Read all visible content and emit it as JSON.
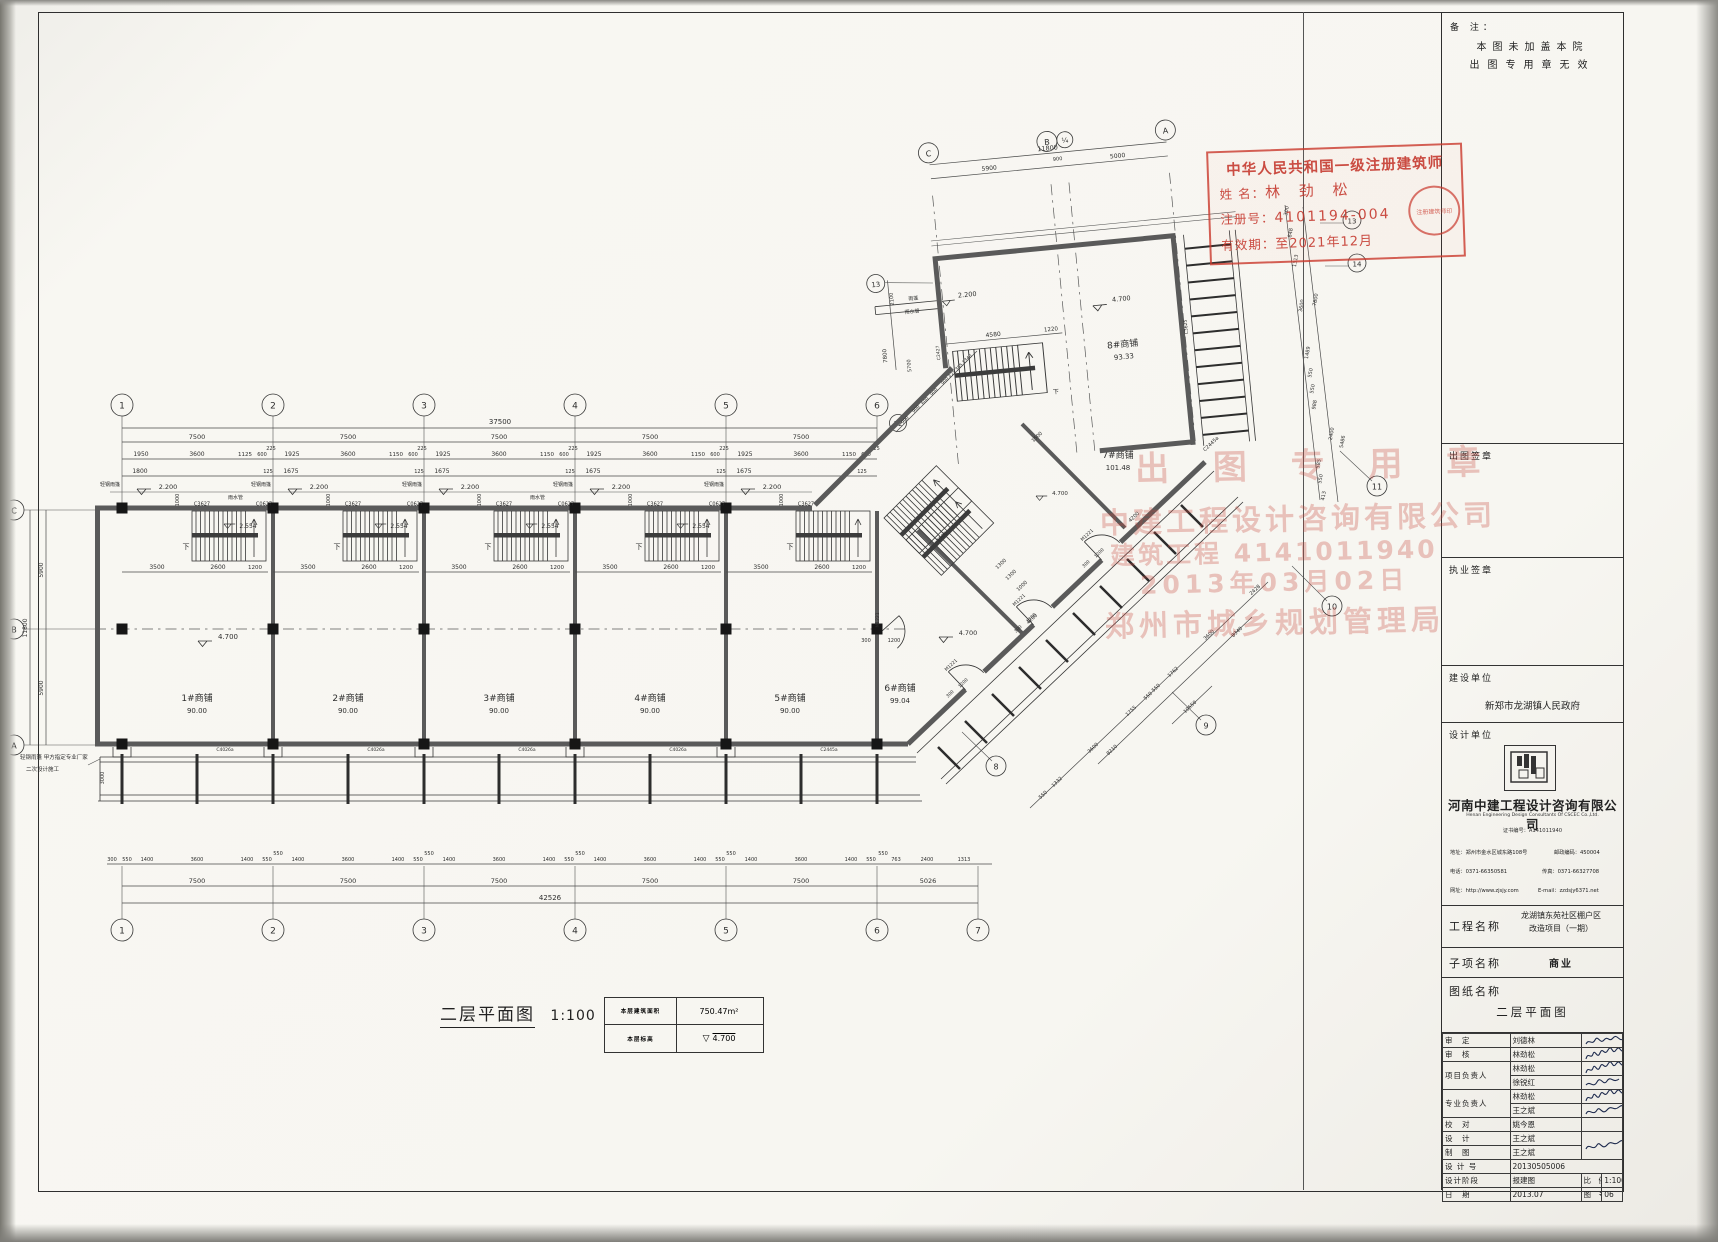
{
  "sheet": {
    "remark_label": "备 注：",
    "remark1": "本图未加盖本院",
    "remark2": "出图专用章无效"
  },
  "architect_stamp": {
    "title": "中华人民共和国一级注册建筑师",
    "name_label": "姓 名：",
    "name": "林 劲 松",
    "reg_label": "注册号：",
    "reg": "4101194-004",
    "valid_label": "有效期：",
    "valid": "至2021年12月",
    "seal": "注册建筑师印"
  },
  "faint_stamps": {
    "l1": "出 图 专 用 章",
    "l2": "中建工程设计咨询有限公司",
    "l3": "建筑工程 4141011940",
    "l4": "2013年03月02日",
    "l5": "郑州市城乡规划管理局"
  },
  "title_block": {
    "sign_out": "出图签章",
    "practice": "执业签章",
    "client_label": "建设单位",
    "client": "新郑市龙湖镇人民政府",
    "designer_label": "设计单位",
    "company": "河南中建工程设计咨询有限公司",
    "company_en": "Henan Engineering Design Consultants Of CSCEC Co.,Ltd.",
    "cert": "证书编号：A141011940",
    "addr": "地址：郑州市金水区城东路108号",
    "post": "邮政编码：450004",
    "tel": "电话：0371-66350581",
    "fax": "传真：0371-66327708",
    "web": "网址：http://www.zjsjy.com",
    "email": "E-mail：zzdsjy6371.net",
    "project_label": "工程名称",
    "project1": "龙湖镇东苑社区棚户区",
    "project2": "改造项目（一期）",
    "sub_label": "子项名称",
    "sub": "商业",
    "drawing_label": "图纸名称",
    "drawing": "二层平面图",
    "rows": [
      {
        "l": "审　定",
        "n": "刘德林"
      },
      {
        "l": "审　核",
        "n": "林劲松"
      },
      {
        "l": "项目负责人",
        "n": "林劲松"
      },
      {
        "l": "",
        "n": "徐锐红"
      },
      {
        "l": "专业负责人",
        "n": "林劲松"
      },
      {
        "l": "",
        "n": "王之斌"
      },
      {
        "l": "校　对",
        "n": "姚今恩"
      },
      {
        "l": "设　计",
        "n": "王之斌"
      },
      {
        "l": "制　图",
        "n": "王之斌"
      }
    ],
    "design_no_label": "设 计 号",
    "design_no": "20130505006",
    "stage_label": "设计阶段",
    "stage": "报建图",
    "scale_label": "比　例",
    "scale": "1:100",
    "date_label": "日　期",
    "date": "2013.07",
    "fig_label": "图　号",
    "fig": "06"
  },
  "caption": {
    "title": "二层平面图",
    "scale": "1:100"
  },
  "area_table": {
    "r1l": "本层建筑面积",
    "r1v": "750.47m²",
    "r2l": "本层标高",
    "r2v": "4.700"
  },
  "plan": {
    "shops": [
      {
        "name": "1#商铺",
        "area": "90.00"
      },
      {
        "name": "2#商铺",
        "area": "90.00"
      },
      {
        "name": "3#商铺",
        "area": "90.00"
      },
      {
        "name": "4#商铺",
        "area": "90.00"
      },
      {
        "name": "5#商铺",
        "area": "90.00"
      },
      {
        "name": "6#商铺",
        "area": "99.04"
      },
      {
        "name": "7#商铺",
        "area": "101.48"
      },
      {
        "name": "8#商铺",
        "area": "93.33"
      }
    ],
    "levels": {
      "v470": "4.700",
      "v220": "2.200",
      "v2554": "2.554"
    },
    "annot": {
      "canopy": "轻钢雨篷",
      "canopy_s": "雨篷",
      "rain": "雨水管",
      "down": "下",
      "note1": "轻钢雨篷 甲方指定专业厂家",
      "note2": "二次设计施工"
    },
    "win": {
      "c3627": "C3627",
      "c0627": "C0627",
      "c4026": "C4026a",
      "c2427": "C2427",
      "c2445": "C2445a",
      "c3625": "C3625"
    },
    "door": {
      "m1221": "M1221"
    },
    "grid": {
      "n1": "1",
      "n2": "2",
      "n3": "3",
      "n4": "4",
      "n5": "5",
      "n6": "6",
      "n7": "7",
      "n8": "8",
      "n9": "9",
      "n10": "10",
      "n11": "11",
      "n12": "12",
      "n13": "13",
      "n14": "14",
      "A": "A",
      "B": "B",
      "C": "C",
      "q": "¼"
    },
    "dims": {
      "d37500": "37500",
      "d7500": "7500",
      "d42526": "42526",
      "d5026": "5026",
      "d1950": "1950",
      "d3600": "3600",
      "d1125": "1125",
      "d1150": "1150",
      "d600": "600",
      "d225": "225",
      "d1925": "1925",
      "d1800": "1800",
      "d125": "125",
      "d1675": "1675",
      "d1000": "1000",
      "d3500": "3500",
      "d2600": "2600",
      "d1200": "1200",
      "d300": "300",
      "d5900": "5900",
      "d11800": "11800",
      "d3000": "3000",
      "d550": "550",
      "d1400": "1400",
      "d763": "763",
      "d2400": "2400",
      "d1313": "1313",
      "d900": "900",
      "d5000": "5000",
      "d4580": "4580",
      "d1220": "1220",
      "d848": "848",
      "d1489": "1489",
      "d988": "988",
      "d5486": "5486",
      "d585": "585",
      "d413": "413",
      "d7800": "7800",
      "d2100": "2100",
      "d5700": "5700",
      "d1332": "1332",
      "d1755": "1755",
      "d1762": "1762",
      "d8210": "8210",
      "d8340": "8340",
      "d10550": "10550",
      "d2428": "2428",
      "d4200": "4200",
      "d1500": "1500",
      "d1300": "1300",
      "d385": "385",
      "d1340": "1340"
    }
  }
}
